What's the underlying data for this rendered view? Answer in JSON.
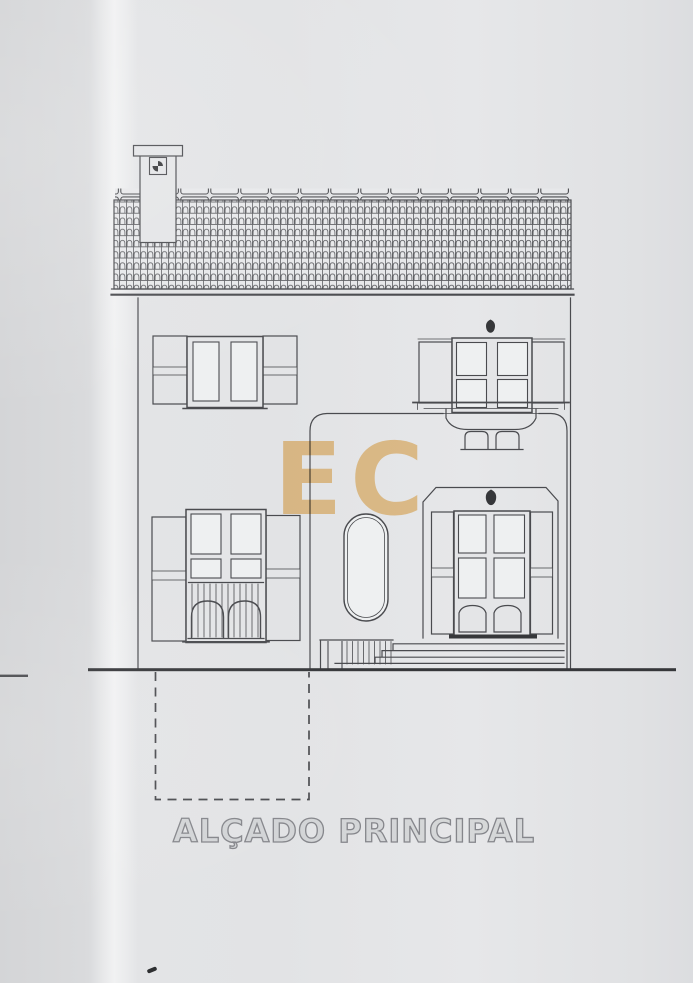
{
  "document": {
    "title": "ALÇADO PRINCIPAL",
    "watermark": "EC"
  },
  "colors": {
    "paper": "#e1e2e4",
    "ink": "#4a4b4f",
    "ink-dark": "#36373a",
    "ink-light": "#85868a",
    "gold": "#f2c98a",
    "title-outline": "#85868b",
    "fill-wall": "#e4e5e7",
    "fill-pane": "#eef0f1",
    "fill-shutter": "#cdced0"
  }
}
